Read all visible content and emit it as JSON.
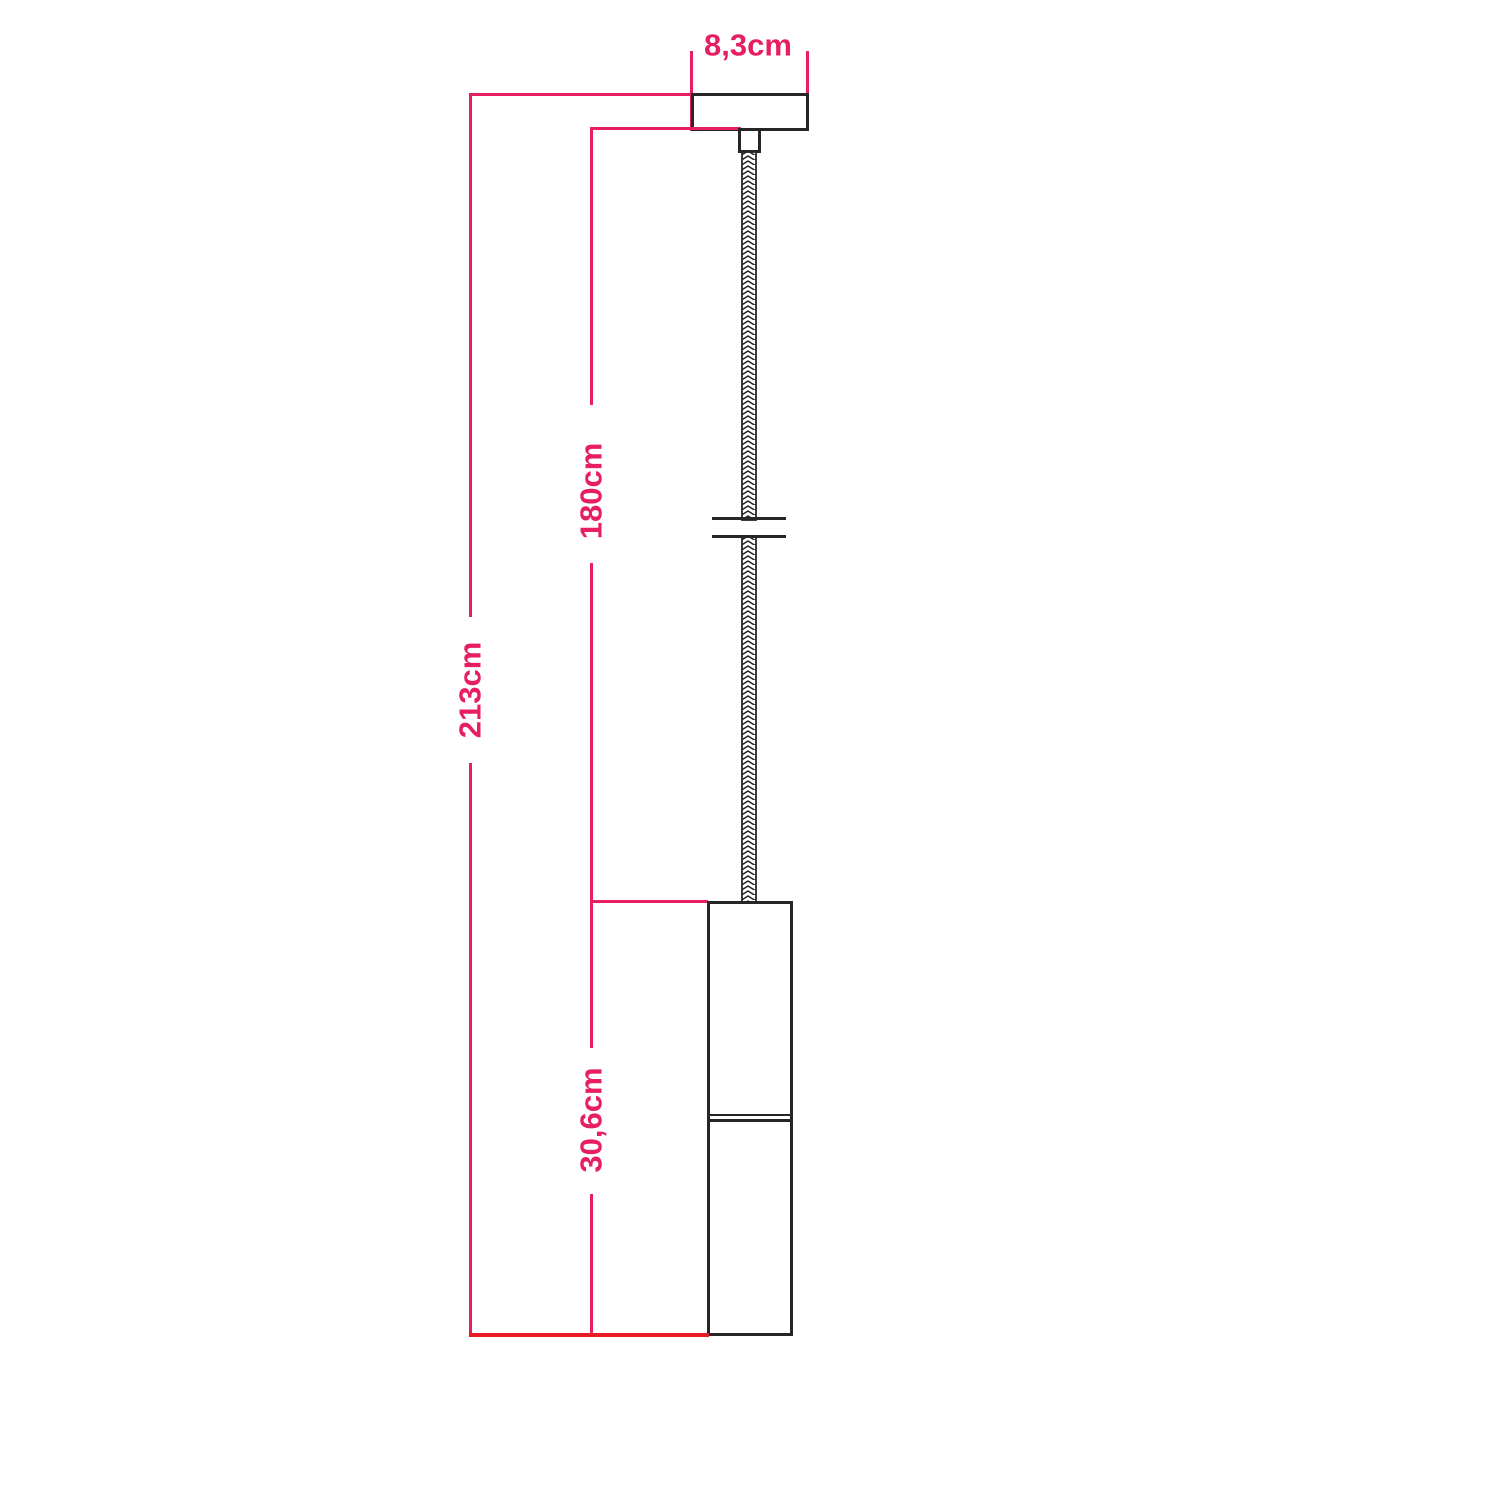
{
  "diagram": {
    "labels": {
      "canopy_width": "8,3cm",
      "total_height": "213cm",
      "suspension_length": "180cm",
      "shade_height": "30,6cm"
    }
  },
  "colors": {
    "dimension_pink": "#e71e5f",
    "floor_red": "#ed1c24",
    "outline_black": "#262626",
    "background": "#ffffff"
  }
}
